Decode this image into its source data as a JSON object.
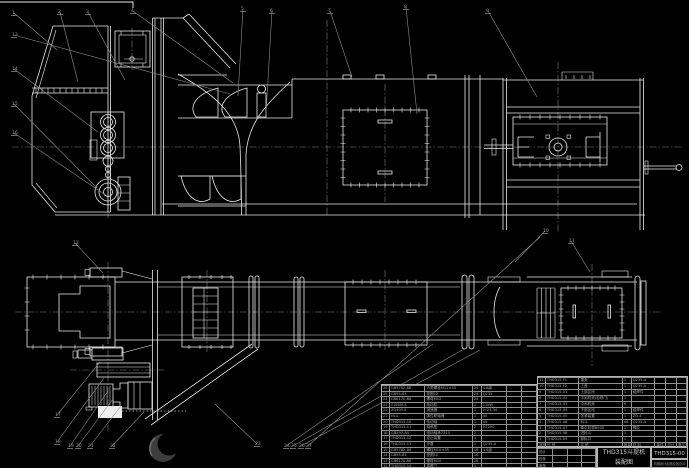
{
  "title_block": {
    "product": "THD315斗提机",
    "doc_type": "装配图",
    "drawing_no": "THD315-00",
    "org": "机械设计制造及其自动化"
  },
  "parts_table_right": {
    "header": [
      "序号",
      "代  号",
      "名  称",
      "数量",
      "材  料",
      "单件",
      "总计",
      "备注"
    ],
    "rows": [
      [
        "11",
        "THD315-F1",
        "罩壳",
        "1",
        "Q235-A",
        "",
        "",
        ""
      ],
      [
        "10",
        "THD315-F2",
        "上盖",
        "1",
        "Q235-A",
        "",
        "",
        ""
      ],
      [
        "9",
        "THD315-01",
        "上部区段",
        "1",
        "组焊件",
        "",
        "",
        ""
      ],
      [
        "8",
        "THD315-02",
        "中间机壳(检修门)",
        "1",
        "",
        "",
        "",
        ""
      ],
      [
        "7",
        "THD315-03",
        "中间机壳",
        "4",
        "",
        "",
        "",
        ""
      ],
      [
        "6",
        "THD315-04",
        "下部区段",
        "1",
        "组焊件",
        "",
        "",
        ""
      ],
      [
        "5",
        "THD315-05",
        "张紧装置",
        "1",
        "ZQ-4",
        "",
        "",
        ""
      ],
      [
        "4",
        "THD315-06",
        "料斗",
        "46",
        "Q235-A",
        "",
        "",
        ""
      ],
      [
        "3",
        "THD315-07",
        "牵引胶带B500",
        "1",
        "橡胶",
        "",
        "",
        ""
      ],
      [
        "2",
        "THD315-08",
        "进料斗",
        "1",
        "",
        "",
        "",
        ""
      ],
      [
        "1",
        "THD315-09",
        "卸料口",
        "1",
        "",
        "",
        "",
        ""
      ]
    ]
  },
  "parts_table_left": {
    "rows": [
      [
        "26",
        "GB5782-86",
        "六角螺栓M12×45",
        "24",
        "4.8级",
        "",
        ""
      ],
      [
        "25",
        "GB95-85",
        "垫圈12",
        "24",
        "Q235",
        "",
        ""
      ],
      [
        "24",
        "GB6170-86",
        "螺母M12",
        "24",
        "",
        "",
        ""
      ],
      [
        "23",
        "Y160M-4",
        "电动机",
        "1",
        "11kW",
        "",
        ""
      ],
      [
        "22",
        "ZQ400-Ⅱ",
        "减速器",
        "1",
        "i=23.34",
        "",
        ""
      ],
      [
        "21",
        "HL4",
        "弹性联轴器",
        "1",
        "45",
        "",
        ""
      ],
      [
        "20",
        "THD315-10",
        "传动轴",
        "1",
        "45",
        "",
        ""
      ],
      [
        "19",
        "THD315-11",
        "轴承座",
        "2",
        "HT200",
        "",
        ""
      ],
      [
        "18",
        "GB297-84",
        "滚动轴承7310",
        "2",
        "",
        "",
        ""
      ],
      [
        "17",
        "THD315-12",
        "逆止装置",
        "1",
        "",
        "",
        ""
      ],
      [
        "16",
        "THD315-13",
        "护罩",
        "1",
        "Q235-A",
        "",
        ""
      ],
      [
        "15",
        "GB5782-86",
        "螺栓M10×35",
        "16",
        "4.8级",
        "",
        ""
      ],
      [
        "14",
        "GB95-85",
        "垫圈10",
        "16",
        "",
        "",
        ""
      ],
      [
        "13",
        "GB6170-86",
        "螺母M10",
        "16",
        "",
        "",
        ""
      ],
      [
        "12",
        "THD315-14",
        "观察门",
        "1",
        "",
        "",
        ""
      ]
    ]
  },
  "sign_grid": {
    "rows": [
      [
        "设计",
        "",
        "",
        ""
      ],
      [
        "校核",
        "",
        "",
        ""
      ],
      [
        "审核",
        "",
        "",
        ""
      ]
    ]
  },
  "balloons": [
    {
      "n": "1",
      "x": 12,
      "y": 10
    },
    {
      "n": "2",
      "x": 58,
      "y": 9
    },
    {
      "n": "3",
      "x": 86,
      "y": 9
    },
    {
      "n": "4",
      "x": 131,
      "y": 8
    },
    {
      "n": "5",
      "x": 241,
      "y": 6
    },
    {
      "n": "6",
      "x": 270,
      "y": 8
    },
    {
      "n": "7",
      "x": 328,
      "y": 8
    },
    {
      "n": "8",
      "x": 404,
      "y": 4
    },
    {
      "n": "9",
      "x": 486,
      "y": 8
    },
    {
      "n": "10",
      "x": 543,
      "y": 228
    },
    {
      "n": "11",
      "x": 569,
      "y": 238
    },
    {
      "n": "12",
      "x": 73,
      "y": 240
    },
    {
      "n": "13",
      "x": 12,
      "y": 32
    },
    {
      "n": "14",
      "x": 12,
      "y": 66
    },
    {
      "n": "15",
      "x": 12,
      "y": 101
    },
    {
      "n": "16",
      "x": 12,
      "y": 130
    },
    {
      "n": "17",
      "x": 55,
      "y": 412
    },
    {
      "n": "18",
      "x": 55,
      "y": 439
    },
    {
      "n": "19",
      "x": 68,
      "y": 443
    },
    {
      "n": "20",
      "x": 76,
      "y": 443
    },
    {
      "n": "21",
      "x": 88,
      "y": 443
    },
    {
      "n": "22",
      "x": 110,
      "y": 443
    },
    {
      "n": "23",
      "x": 255,
      "y": 441
    },
    {
      "n": "24",
      "x": 284,
      "y": 443
    },
    {
      "n": "25",
      "x": 291,
      "y": 443
    },
    {
      "n": "26",
      "x": 299,
      "y": 443
    },
    {
      "n": "27",
      "x": 306,
      "y": 443
    }
  ]
}
